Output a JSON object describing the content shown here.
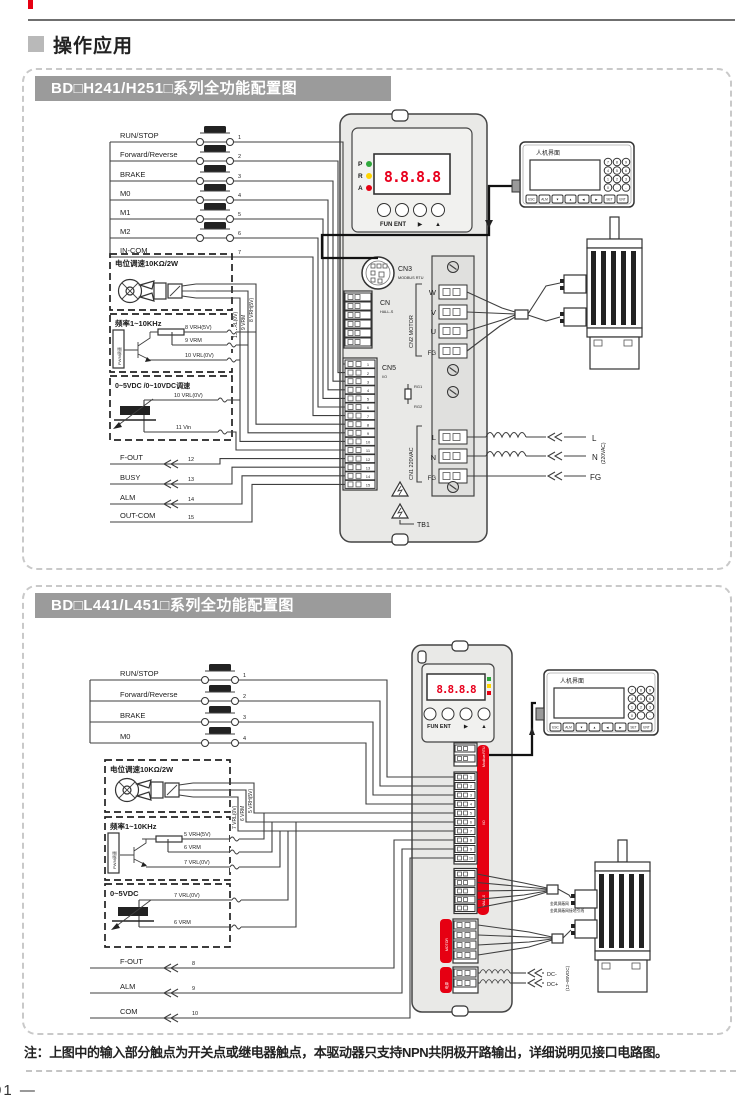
{
  "header": {
    "title": "操作应用"
  },
  "footer": {
    "note": "注：上图中的输入部分触点为开关点或继电器触点，本驱动器只支持NPN共阴极开路输出，详细说明见接口电路图。",
    "page_number": "01 —"
  },
  "colors": {
    "accent_red": "#e60012",
    "title_bar_gray": "#9b9b9b",
    "led_green": "#2fa83c",
    "led_yellow": "#ffd400",
    "led_red": "#e60012",
    "segment_red": "#e8001d"
  },
  "panel1": {
    "title": "BD□H241/H251□系列全功能配置图",
    "switches": [
      {
        "label": "RUN/STOP",
        "pin": "1"
      },
      {
        "label": "Forward/Reverse",
        "pin": "2"
      },
      {
        "label": "BRAKE",
        "pin": "3"
      },
      {
        "label": "M0",
        "pin": "4"
      },
      {
        "label": "M1",
        "pin": "5"
      },
      {
        "label": "M2",
        "pin": "6"
      },
      {
        "label": "IN-COM",
        "pin": "7"
      }
    ],
    "pot_box": {
      "title": "电位调速10KΩ/2W",
      "wire_labels": [
        "8 VRH(5V)",
        "9 VRM",
        "10 VRL(0V)"
      ]
    },
    "pwm_box": {
      "title": "频率1~10KHz",
      "side_label": "PWM调速",
      "wire_labels": [
        "8 VRH(5V)",
        "9 VRM",
        "10 VRL(0V)"
      ]
    },
    "vdc_box": {
      "title": "0~5VDC /0~10VDC调速",
      "wire_labels": [
        "10 VRL(0V)",
        "11 Vin"
      ]
    },
    "outputs": [
      {
        "label": "F-OUT",
        "pin": "12"
      },
      {
        "label": "BUSY",
        "pin": "13"
      },
      {
        "label": "ALM",
        "pin": "14"
      },
      {
        "label": "OUT-COM",
        "pin": "15"
      }
    ],
    "strip_pins": [
      "1",
      "2",
      "3",
      "4",
      "5",
      "6",
      "7",
      "8",
      "9",
      "10",
      "11",
      "12",
      "13",
      "14",
      "15"
    ],
    "driver": {
      "led_labels": [
        "P",
        "R",
        "A"
      ],
      "display": "8.8.8.8",
      "btn_label": "FUN ENT",
      "btn_arrow1": "▶",
      "btn_arrow2": "▲",
      "cn3": "CN3",
      "cn3_sub": "MODBUS RTU",
      "cn_hall": "CN",
      "cn_hall_sub": "HALL-S",
      "cn5": "CN5",
      "cn5_sub": "I/O",
      "cn2_motor": "CN2 MOTOR",
      "motor_pins": [
        "W",
        "V",
        "U",
        "FG"
      ],
      "rg1": "RG1",
      "rg2": "RG2",
      "cn1": "CN1 220VAC",
      "l": "L",
      "n": "N",
      "fg": "FG",
      "tb1": "TB1"
    },
    "power": {
      "l": "L",
      "n": "N",
      "fg": "FG",
      "voltage": "(220VAC)"
    },
    "hmi": {
      "title": "人机界面",
      "keypad": [
        "7",
        "8",
        "9",
        "4",
        "5",
        "6",
        "1",
        "2",
        "3",
        "0",
        ".",
        "-"
      ],
      "keys": [
        "ESC",
        "ALM",
        "▼",
        "▲",
        "◀",
        "▶",
        "SET",
        "ENT"
      ]
    }
  },
  "panel2": {
    "title": "BD□L441/L451□系列全功能配置图",
    "switches": [
      {
        "label": "RUN/STOP",
        "pin": "1"
      },
      {
        "label": "Forward/Reverse",
        "pin": "2"
      },
      {
        "label": "BRAKE",
        "pin": "3"
      },
      {
        "label": "M0",
        "pin": "4"
      }
    ],
    "pot_box": {
      "title": "电位调速10KΩ/2W",
      "wire_labels": [
        "5 VRH(5V)",
        "6 VRM",
        "7 VRL(0V)"
      ]
    },
    "pwm_box": {
      "title": "频率1~10KHz",
      "side_label": "PWM调速",
      "wire_labels": [
        "5 VRH(5V)",
        "6 VRM",
        "7 VRL(0V)"
      ]
    },
    "vdc_box": {
      "title": "0~5VDC",
      "wire_labels": [
        "7 VRL(0V)",
        "6 VRM"
      ]
    },
    "outputs": [
      {
        "label": "F-OUT",
        "pin": "8"
      },
      {
        "label": "ALM",
        "pin": "9"
      },
      {
        "label": "COM",
        "pin": "10"
      }
    ],
    "strip_pins": [
      "1",
      "2",
      "3",
      "4",
      "5",
      "6",
      "7",
      "8",
      "9",
      "10"
    ],
    "driver": {
      "display": "8.8.8.8",
      "btn_label": "FUN ENT",
      "btn_arrow1": "▶",
      "btn_arrow2": "▲",
      "band_labels": [
        "Modbus RTU",
        "I/O",
        "HALL-S",
        "MOTOR",
        "电源"
      ]
    },
    "hmi": {
      "title": "人机界面",
      "keypad": [
        "7",
        "8",
        "9",
        "4",
        "5",
        "6",
        "1",
        "2",
        "3",
        "0",
        ".",
        "-"
      ],
      "keys": [
        "ESC",
        "ALM",
        "▼",
        "▲",
        "◀",
        "▶",
        "SET",
        "ENT"
      ]
    },
    "shield": {
      "line1": "金属屏蔽网",
      "line2": "金属屏蔽网接地引线"
    },
    "dc": {
      "minus": "DC-",
      "plus": "DC+",
      "range": "(12~80VDC)"
    }
  }
}
